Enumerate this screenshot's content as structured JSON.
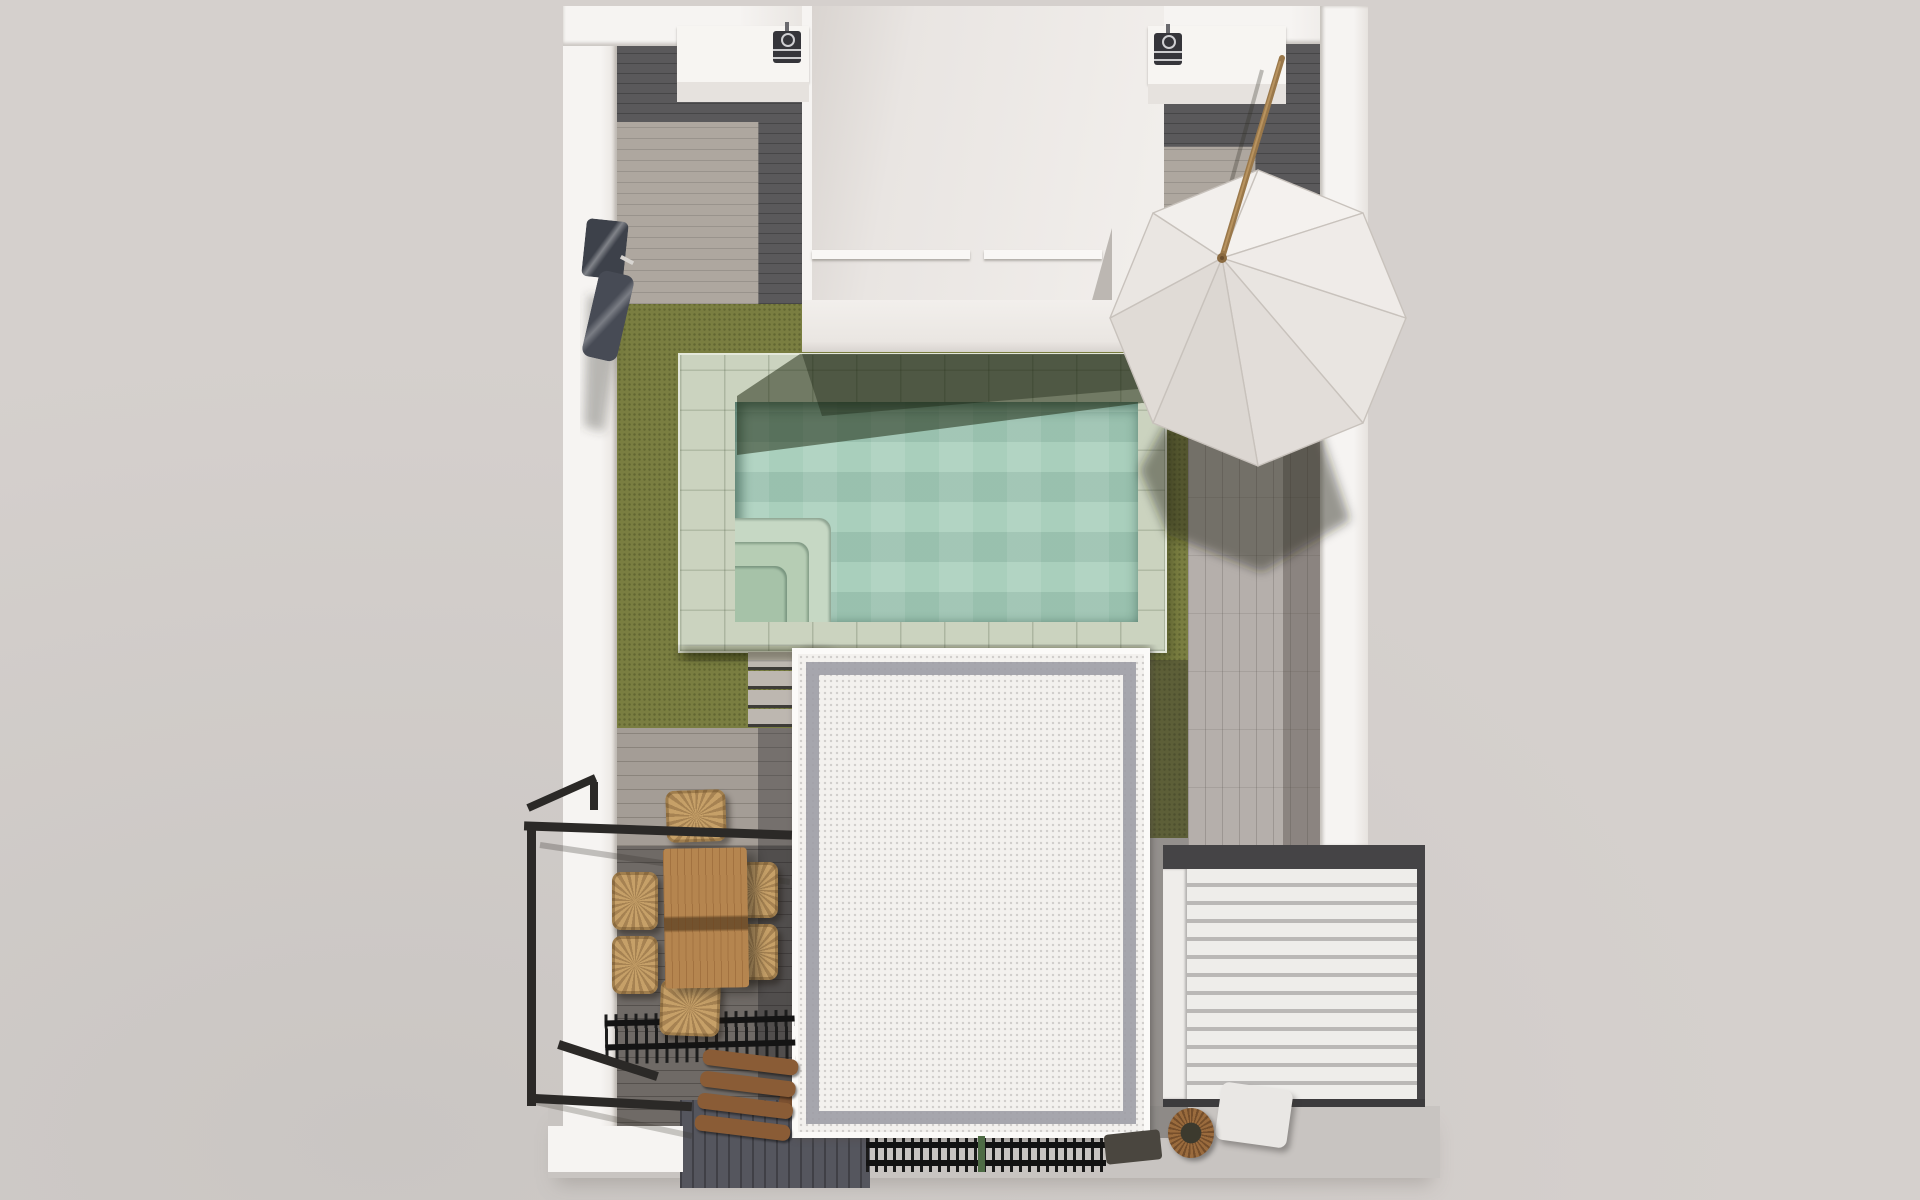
{
  "scene": {
    "title": "Top-down 3D architectural render of a rooftop terrace with pool",
    "type": "architectural-render-plan-view",
    "visible_text": [],
    "elements": [
      "outer-white-walls",
      "top-left-utility-alcove",
      "top-right-utility-alcove",
      "central-stairwell-roof-recess",
      "ac-unit-left",
      "ac-unit-right",
      "artificial-turf",
      "swimming-pool",
      "pool-corner-steps",
      "garden-stairs",
      "white-parasol",
      "parasol-pole",
      "stone-patio-right",
      "roof-block-gravel-border",
      "louvered-pergola",
      "dining-table",
      "six-wicker-chairs",
      "black-metal-railing",
      "slatted-pergola-comb",
      "wooden-bench",
      "floor-grate",
      "planter-pot",
      "outdoor-shower-unit",
      "wood-deck-dining",
      "cast-shadows"
    ]
  },
  "counts": {
    "louver_slats": 13,
    "pool_corner_steps": 3,
    "garden_stair_treads": 5,
    "dining_chairs": 6,
    "ac_units": 2,
    "umbrella_panels": 8
  },
  "colors": {
    "bg": "#d5d0cd",
    "bg_light": "#cac6c3",
    "wall": "#f6f4f2",
    "wall_shade": "#e7e3df",
    "recess": "#e9e5e2",
    "floor_dark": "#5a595b",
    "floor_light": "#aea79f",
    "turf": "#7a7e41",
    "turf_shadow": "#2c3414",
    "stone": "#b5afab",
    "stone_shadow": "#6e6965",
    "pool_coping": "#cbd3bf",
    "pool_water": "#a9cfbc",
    "pool_water_shadow": "#5e9181",
    "roof_white": "#f3f1ee",
    "gravel": "#9d9da5",
    "louver_slat": "#eeedea",
    "louver_gap": "#bab8b6",
    "beam_dark": "#454446",
    "deck_light": "#a49d96",
    "deck_dark": "#6f6a66",
    "subwall": "#55565e",
    "wood_table": "#b5854f",
    "wicker": "#c6a068",
    "wood_dark": "#8a5c36",
    "metal_black": "#2b2927",
    "canopy": "#efecea",
    "pole": "#9a784a",
    "ground": "#c8c4c1",
    "ac_dark": "#35353a",
    "plant": "#4e6b45"
  }
}
